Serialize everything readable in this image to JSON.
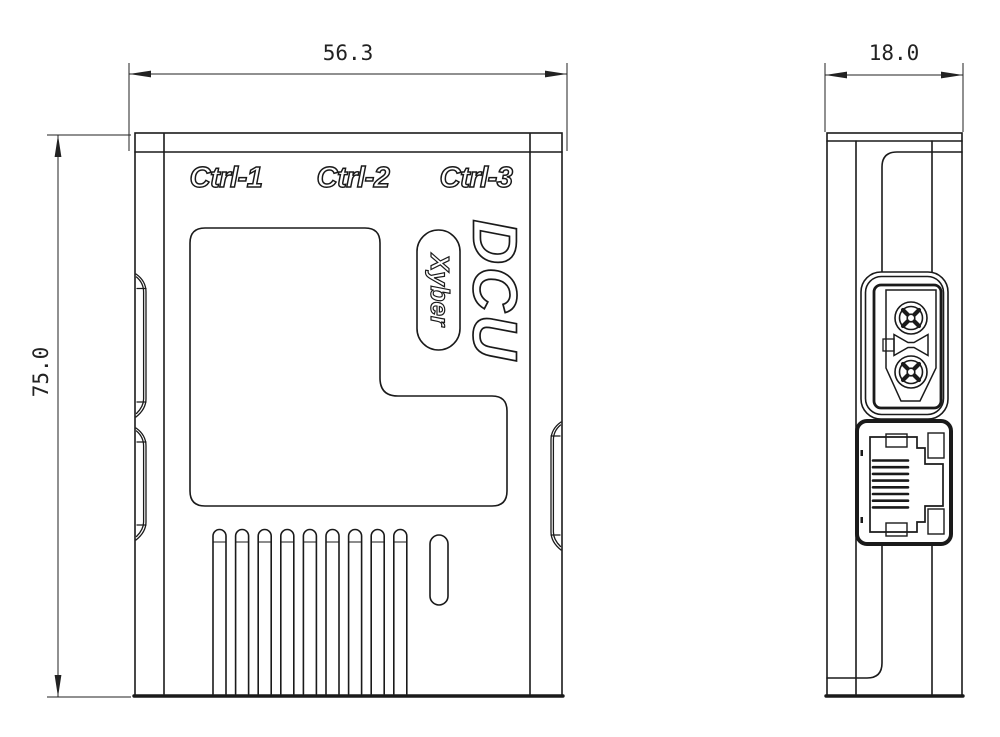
{
  "view": {
    "background": "#ffffff",
    "line_color": "#1a1a1a"
  },
  "front_view": {
    "port_labels": [
      "Ctrl-1",
      "Ctrl-2",
      "Ctrl-3"
    ],
    "product_name": "DCU",
    "brand_badge": "Xyber",
    "vent_slot_count": 9
  },
  "side_view": {
    "connector_names": [
      "xt30-power-connector",
      "rj45-ethernet-port"
    ],
    "rj45_pin_count": 8
  },
  "dimensions": {
    "width": {
      "label": "56.3",
      "value": 56.3
    },
    "height": {
      "label": "75.0",
      "value": 75.0
    },
    "depth": {
      "label": "18.0",
      "value": 18.0
    }
  }
}
